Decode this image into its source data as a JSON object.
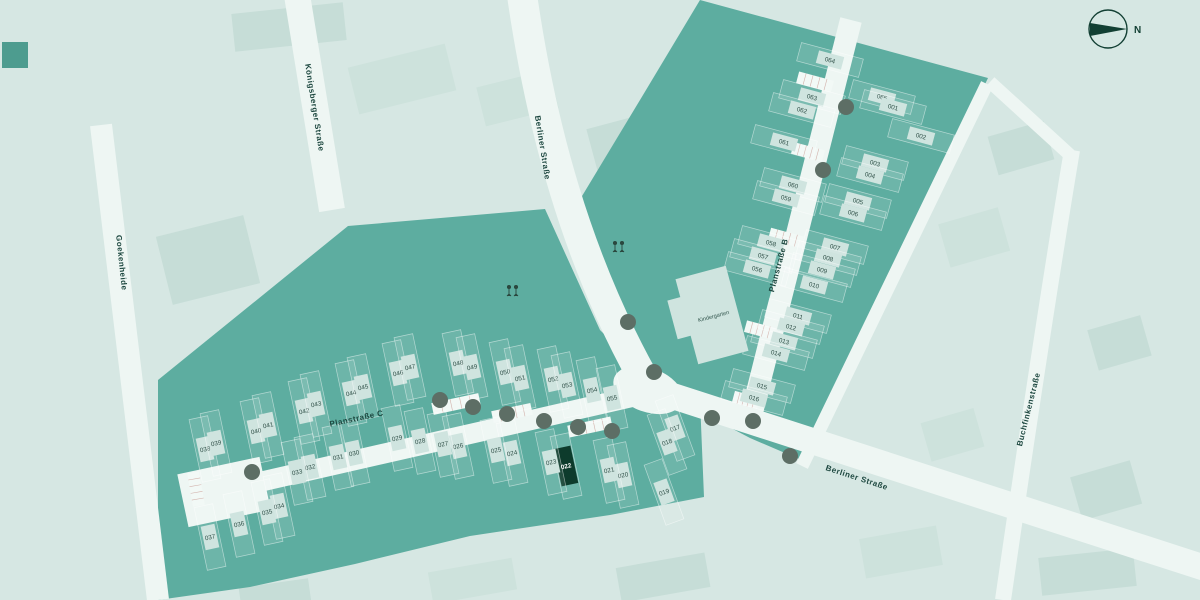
{
  "palette": {
    "background": "#d6e7e3",
    "development_area": "#5dada0",
    "road": "#eef6f3",
    "building": "#cfe4df",
    "highlight": "#0d3b2c",
    "plot_label": "#2f4f47",
    "street_label": "#1c473f",
    "tree": "#5d6e65"
  },
  "compass": {
    "label": "N"
  },
  "kindergarten": {
    "label": "Kindergarten"
  },
  "highlighted_plot": "022",
  "streets": [
    {
      "id": "koenigsberger-strasse",
      "label": "Königsberger Straße",
      "x": 312,
      "y": 108,
      "rot": 81
    },
    {
      "id": "goekenheide",
      "label": "Goekenheide",
      "x": 119,
      "y": 263,
      "rot": 84
    },
    {
      "id": "berliner-strasse-nord",
      "label": "Berliner Straße",
      "x": 540,
      "y": 148,
      "rot": 81
    },
    {
      "id": "berliner-strasse-sued",
      "label": "Berliner Straße",
      "x": 856,
      "y": 480,
      "rot": 18
    },
    {
      "id": "planstrasse-b",
      "label": "Planstraße B",
      "x": 781,
      "y": 266,
      "rot": -75
    },
    {
      "id": "planstrasse-c",
      "label": "Planstraße C",
      "x": 357,
      "y": 421,
      "rot": -12
    },
    {
      "id": "buchfinkenstrasse",
      "label": "Buchfinkenstraße",
      "x": 1031,
      "y": 410,
      "rot": -76
    }
  ],
  "plots": [
    {
      "n": "064",
      "x": 830,
      "y": 60,
      "r": 15,
      "c": "b"
    },
    {
      "n": "063",
      "x": 812,
      "y": 97,
      "r": 15,
      "c": "b"
    },
    {
      "n": "062",
      "x": 802,
      "y": 110,
      "r": 15,
      "c": "b"
    },
    {
      "n": "061",
      "x": 784,
      "y": 142,
      "r": 15,
      "c": "b"
    },
    {
      "n": "060",
      "x": 793,
      "y": 185,
      "r": 15,
      "c": "b"
    },
    {
      "n": "059",
      "x": 786,
      "y": 198,
      "r": 15,
      "c": "b"
    },
    {
      "n": "058",
      "x": 771,
      "y": 243,
      "r": 15,
      "c": "b"
    },
    {
      "n": "057",
      "x": 763,
      "y": 256,
      "r": 15,
      "c": "b"
    },
    {
      "n": "056",
      "x": 757,
      "y": 269,
      "r": 15,
      "c": "b"
    },
    {
      "n": "065",
      "x": 882,
      "y": 97,
      "r": 15,
      "c": "b"
    },
    {
      "n": "001",
      "x": 893,
      "y": 107,
      "r": 15,
      "c": "b"
    },
    {
      "n": "002",
      "x": 921,
      "y": 136,
      "r": 15,
      "c": "b"
    },
    {
      "n": "003",
      "x": 875,
      "y": 163,
      "r": 15,
      "c": "b"
    },
    {
      "n": "004",
      "x": 870,
      "y": 175,
      "r": 15,
      "c": "b"
    },
    {
      "n": "005",
      "x": 858,
      "y": 201,
      "r": 15,
      "c": "b"
    },
    {
      "n": "006",
      "x": 853,
      "y": 213,
      "r": 15,
      "c": "b"
    },
    {
      "n": "007",
      "x": 835,
      "y": 247,
      "r": 15,
      "c": "b"
    },
    {
      "n": "008",
      "x": 828,
      "y": 258,
      "r": 15,
      "c": "b"
    },
    {
      "n": "009",
      "x": 822,
      "y": 270,
      "r": 15,
      "c": "b"
    },
    {
      "n": "010",
      "x": 814,
      "y": 285,
      "r": 15,
      "c": "b"
    },
    {
      "n": "011",
      "x": 798,
      "y": 316,
      "r": 15,
      "c": "b"
    },
    {
      "n": "012",
      "x": 791,
      "y": 327,
      "r": 15,
      "c": "b"
    },
    {
      "n": "013",
      "x": 784,
      "y": 341,
      "r": 15,
      "c": "b"
    },
    {
      "n": "014",
      "x": 776,
      "y": 353,
      "r": 15,
      "c": "b"
    },
    {
      "n": "015",
      "x": 762,
      "y": 386,
      "r": 15,
      "c": "b"
    },
    {
      "n": "016",
      "x": 754,
      "y": 398,
      "r": 15,
      "c": "b"
    },
    {
      "n": "017",
      "x": 675,
      "y": 428,
      "r": -20,
      "c": "c"
    },
    {
      "n": "018",
      "x": 667,
      "y": 442,
      "r": -20,
      "c": "c"
    },
    {
      "n": "019",
      "x": 664,
      "y": 492,
      "r": -20,
      "c": "c"
    },
    {
      "n": "020",
      "x": 623,
      "y": 475,
      "r": -12,
      "c": "c"
    },
    {
      "n": "021",
      "x": 609,
      "y": 470,
      "r": -12,
      "c": "c"
    },
    {
      "n": "022",
      "x": 566,
      "y": 466,
      "r": -12,
      "c": "c",
      "hl": true
    },
    {
      "n": "023",
      "x": 551,
      "y": 462,
      "r": -12,
      "c": "c"
    },
    {
      "n": "024",
      "x": 512,
      "y": 453,
      "r": -12,
      "c": "c"
    },
    {
      "n": "025",
      "x": 496,
      "y": 450,
      "r": -12,
      "c": "c"
    },
    {
      "n": "026",
      "x": 458,
      "y": 446,
      "r": -12,
      "c": "c"
    },
    {
      "n": "027",
      "x": 443,
      "y": 444,
      "r": -12,
      "c": "c"
    },
    {
      "n": "028",
      "x": 420,
      "y": 441,
      "r": -12,
      "c": "c"
    },
    {
      "n": "029",
      "x": 397,
      "y": 438,
      "r": -12,
      "c": "c"
    },
    {
      "n": "030",
      "x": 354,
      "y": 453,
      "r": -12,
      "c": "c"
    },
    {
      "n": "031",
      "x": 338,
      "y": 457,
      "r": -12,
      "c": "c"
    },
    {
      "n": "032",
      "x": 310,
      "y": 467,
      "r": -12,
      "c": "c"
    },
    {
      "n": "033",
      "x": 297,
      "y": 472,
      "r": -12,
      "c": "c"
    },
    {
      "n": "034",
      "x": 279,
      "y": 506,
      "r": -12,
      "c": "c"
    },
    {
      "n": "035",
      "x": 267,
      "y": 512,
      "r": -12,
      "c": "c"
    },
    {
      "n": "036",
      "x": 239,
      "y": 524,
      "r": -12,
      "c": "c"
    },
    {
      "n": "037",
      "x": 210,
      "y": 537,
      "r": -12,
      "c": "c"
    },
    {
      "n": "038",
      "x": 205,
      "y": 449,
      "r": -12,
      "c": "c"
    },
    {
      "n": "039",
      "x": 216,
      "y": 443,
      "r": -12,
      "c": "c"
    },
    {
      "n": "040",
      "x": 256,
      "y": 431,
      "r": -12,
      "c": "c"
    },
    {
      "n": "041",
      "x": 268,
      "y": 425,
      "r": -12,
      "c": "c"
    },
    {
      "n": "042",
      "x": 304,
      "y": 411,
      "r": -12,
      "c": "c"
    },
    {
      "n": "043",
      "x": 316,
      "y": 404,
      "r": -12,
      "c": "c"
    },
    {
      "n": "044",
      "x": 351,
      "y": 393,
      "r": -12,
      "c": "c"
    },
    {
      "n": "045",
      "x": 363,
      "y": 387,
      "r": -12,
      "c": "c"
    },
    {
      "n": "046",
      "x": 398,
      "y": 373,
      "r": -12,
      "c": "c"
    },
    {
      "n": "047",
      "x": 410,
      "y": 367,
      "r": -12,
      "c": "c"
    },
    {
      "n": "048",
      "x": 458,
      "y": 363,
      "r": -12,
      "c": "c"
    },
    {
      "n": "049",
      "x": 472,
      "y": 367,
      "r": -12,
      "c": "c"
    },
    {
      "n": "050",
      "x": 505,
      "y": 372,
      "r": -12,
      "c": "c"
    },
    {
      "n": "051",
      "x": 520,
      "y": 378,
      "r": -12,
      "c": "c"
    },
    {
      "n": "052",
      "x": 553,
      "y": 379,
      "r": -12,
      "c": "c"
    },
    {
      "n": "053",
      "x": 567,
      "y": 385,
      "r": -12,
      "c": "c"
    },
    {
      "n": "054",
      "x": 592,
      "y": 390,
      "r": -12,
      "c": "c"
    },
    {
      "n": "055",
      "x": 612,
      "y": 398,
      "r": -12,
      "c": "c"
    }
  ],
  "trees": [
    [
      846,
      107
    ],
    [
      823,
      170
    ],
    [
      628,
      322
    ],
    [
      654,
      372
    ],
    [
      712,
      418
    ],
    [
      753,
      421
    ],
    [
      790,
      456
    ],
    [
      252,
      472
    ],
    [
      440,
      400
    ],
    [
      473,
      407
    ],
    [
      507,
      414
    ],
    [
      544,
      421
    ],
    [
      578,
      427
    ],
    [
      612,
      431
    ]
  ],
  "parking_strips": [
    [
      815,
      82,
      15,
      36
    ],
    [
      808,
      152,
      15,
      32
    ],
    [
      786,
      238,
      15,
      34
    ],
    [
      760,
      330,
      15,
      30
    ],
    [
      746,
      400,
      15,
      26
    ],
    [
      456,
      404,
      -12,
      48
    ],
    [
      512,
      413,
      -12,
      40
    ],
    [
      590,
      427,
      -12,
      44
    ],
    [
      196,
      489,
      80,
      34
    ]
  ]
}
